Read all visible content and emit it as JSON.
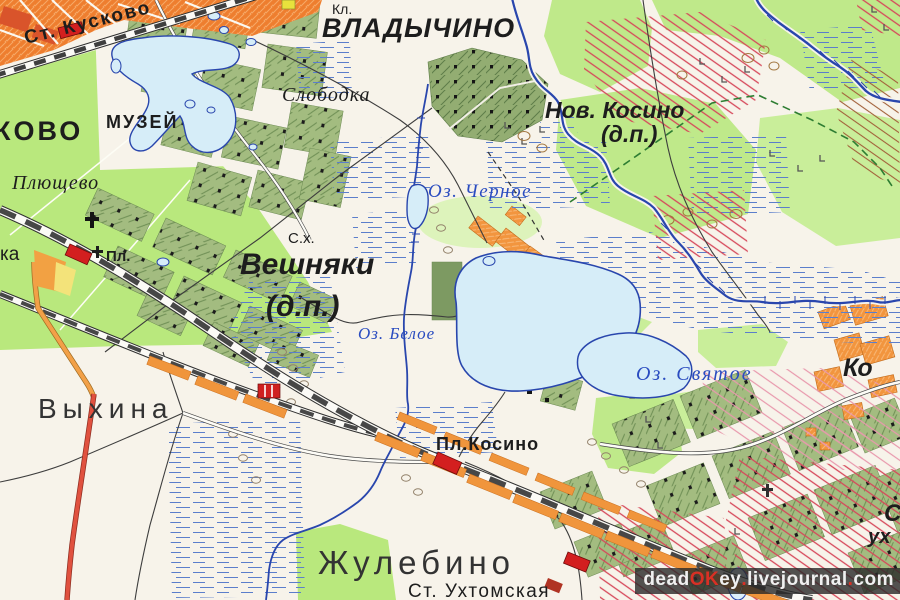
{
  "map": {
    "labels": {
      "st_kuskovo": "Ст. Кусково",
      "kovo_partial": "КОВО",
      "muzey": "МУЗЕЙ",
      "plyushchevo": "Плющево",
      "kl": "Кл.",
      "vladychino": "ВЛАДЫЧИНО",
      "slobodka": "Слободка",
      "nov_kosino": "Нов. Косино",
      "nov_kosino_dp": "(д.п.)",
      "oz_chernoye": "Оз. Черное",
      "s_kh": "С.х.",
      "veshnyaki": "Вешняки",
      "veshnyaki_dp": "(д.п.)",
      "oz_beloye": "Оз. Белое",
      "oz_svyatoye": "Оз. Святое",
      "vykhina": "Выхина",
      "ka_partial": "ка",
      "pl_platform": "Пл.",
      "pl_kosino": "Пл.Косино",
      "zhulebino": "Жулебино",
      "st_ukhtomskaya": "Ст. Ухтомская",
      "ko_partial": "Ко",
      "s_partial": "С",
      "ukh_partial": "ух"
    },
    "watermark": {
      "w1": "dead",
      "w2": "OK",
      "w3": "ey",
      "d1": ".",
      "w4": "livejournal",
      "d2": ".",
      "w5": "com"
    },
    "colors": {
      "background": "#f7f3ea",
      "parkland_green": "#b9e87d",
      "light_green": "#c9ee9a",
      "settlement_block_green": "#a3bc80",
      "urban_orange": "#ee7e2f",
      "village_orange": "#f2953e",
      "water_fill": "#d6edf8",
      "water_line": "#2946ad",
      "marsh_dash": "#5b7ecb",
      "railway": "#474747",
      "highway_red": "#e0513f",
      "road_orange": "#f2a048",
      "hatch_red": "#d6475a",
      "station_red": "#d31f1f"
    }
  }
}
